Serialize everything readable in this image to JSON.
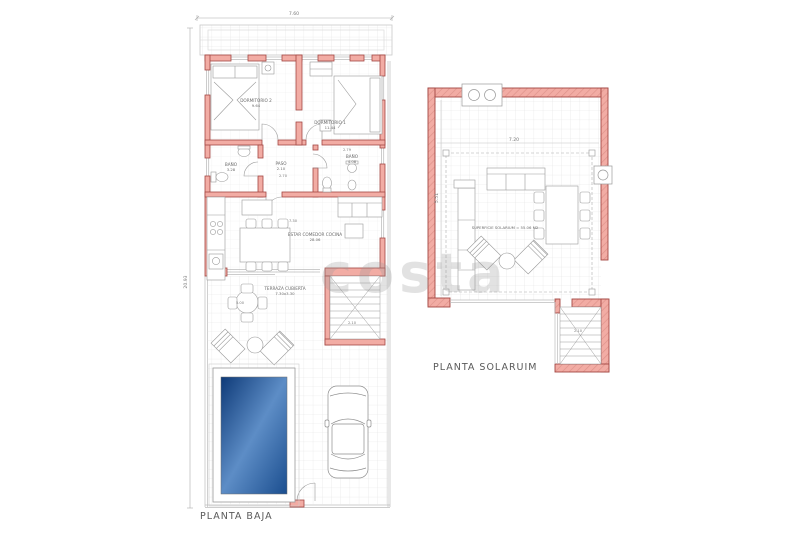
{
  "watermark": {
    "text": "costa"
  },
  "ground_floor": {
    "title": "PLANTA BAJA",
    "dims": {
      "top_width": "7.60",
      "left_height": "20.93",
      "living_width": "7.30",
      "paso_depth": "2.70",
      "bath_width": "2.79",
      "terrace_table": "5.00",
      "stairs": "2.10"
    },
    "rooms": {
      "dorm2": {
        "name": "DORMITORIO 2",
        "area": "9.64"
      },
      "dorm1": {
        "name": "DORMITORIO 1",
        "area": "11.44"
      },
      "bath_left": {
        "name": "BAÑO",
        "area": "3.28"
      },
      "paso": {
        "name": "PASO",
        "area": "2.10"
      },
      "bath_right": {
        "name": "BAÑO",
        "area": "4.08"
      },
      "living": {
        "name": "ESTAR COMEDOR COCINA",
        "area": "28.06"
      },
      "terrace": {
        "name": "TERRAZA CUBIERTA",
        "dims": "7.30x3.30"
      }
    }
  },
  "solarium": {
    "title": "PLANTA SOLARUIM",
    "surface_label": "SUPERFICIE SOLARIUM = 55.06 M2",
    "dims": {
      "width": "7.20",
      "height": "5.51",
      "stairs": "2.10"
    }
  },
  "colors": {
    "wall_fill": "#F2ACA4",
    "wall_stroke": "#A34743",
    "pool_dark": "#0E3A78",
    "pool_light": "#5D8DC6"
  }
}
